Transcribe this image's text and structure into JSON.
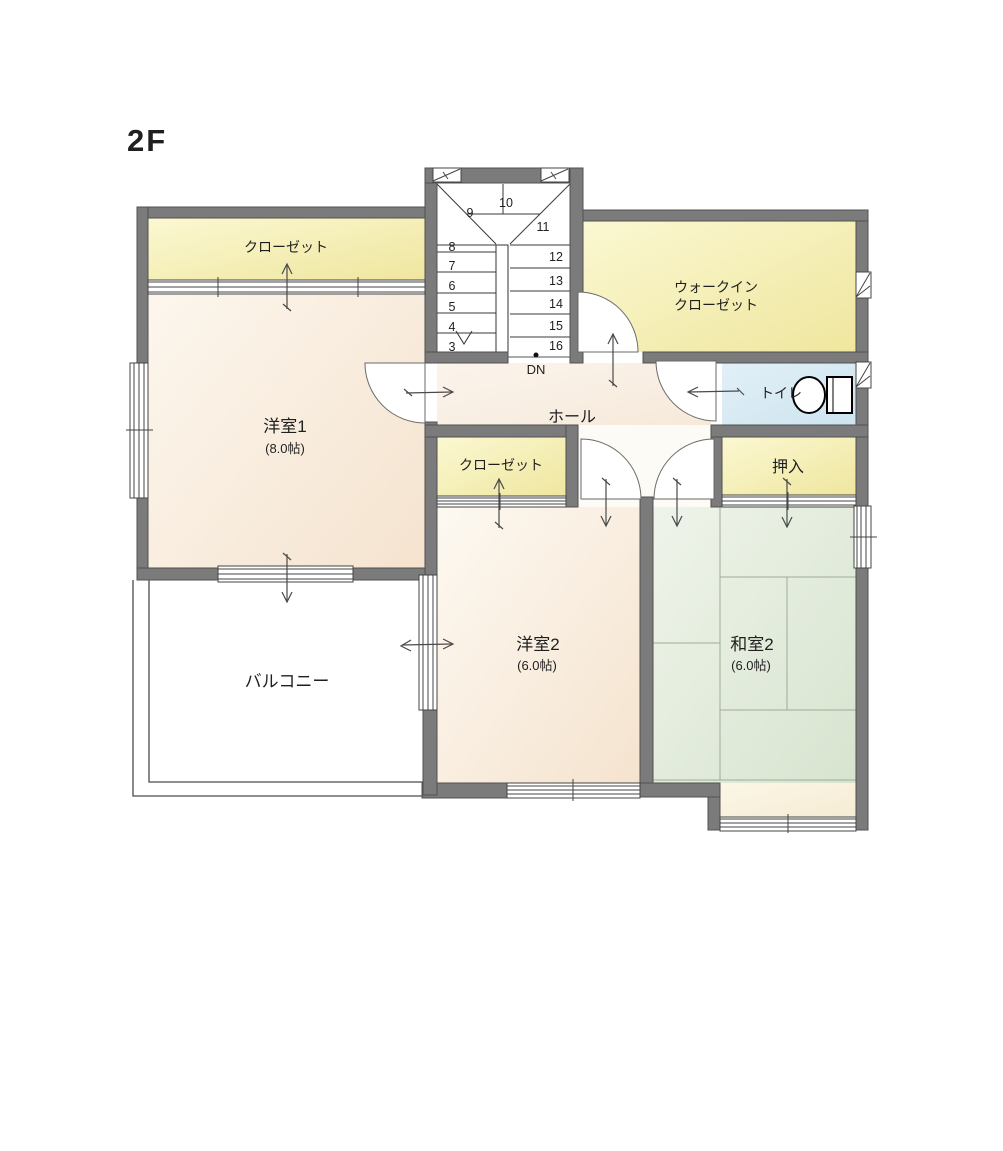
{
  "floor_label": "2F",
  "stairs": {
    "down_label": "DN",
    "numbers": [
      "3",
      "4",
      "5",
      "6",
      "7",
      "8",
      "9",
      "10",
      "11",
      "12",
      "13",
      "14",
      "15",
      "16"
    ]
  },
  "rooms": {
    "closet1": {
      "label": "クローゼット"
    },
    "wic": {
      "label_line1": "ウォークイン",
      "label_line2": "クローゼット"
    },
    "yoshitsu1": {
      "label": "洋室1",
      "size": "(8.0帖)"
    },
    "hall": {
      "label": "ホール"
    },
    "toilet": {
      "label": "トイレ"
    },
    "closet2": {
      "label": "クローゼット"
    },
    "oshiire": {
      "label": "押入"
    },
    "yoshitsu2": {
      "label": "洋室2",
      "size": "(6.0帖)"
    },
    "washitsu2": {
      "label": "和室2",
      "size": "(6.0帖)"
    },
    "balcony": {
      "label": "バルコニー"
    }
  },
  "colors": {
    "wall": "#7b7b7b",
    "closet_fill": "#f6efac",
    "room_fill": "#f8ead8",
    "tatami_fill": "#e0ead7",
    "toilet_fill": "#d8ecf4",
    "hall_fill": "#f9f0e4",
    "line": "#3a3a3a"
  }
}
